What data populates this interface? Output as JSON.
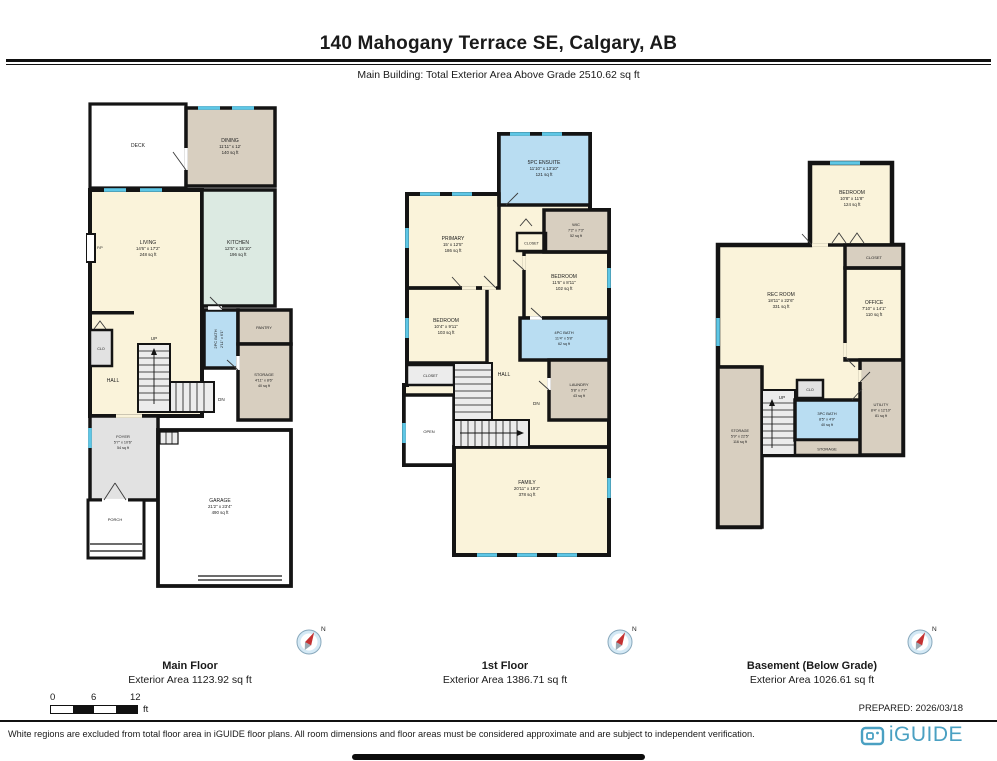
{
  "header": {
    "title": "140 Mahogany Terrace SE, Calgary, AB",
    "subtitle": "Main Building: Total Exterior Area Above Grade 2510.62 sq ft"
  },
  "plans": [
    {
      "name": "Main Floor",
      "area": "Exterior Area 1123.92 sq ft",
      "rooms": {
        "deck": {
          "name": "DECK"
        },
        "dining": {
          "name": "DINING",
          "dims": "11'11\" x 12'",
          "area": "140 sq ft"
        },
        "living": {
          "name": "LIVING",
          "dims": "14'6\" x 17'2\"",
          "area": "248 sq ft"
        },
        "kitchen": {
          "name": "KITCHEN",
          "dims": "12'5\" x 15'10\"",
          "area": "196 sq ft"
        },
        "bath": {
          "name": "2PC BATH",
          "dims": "2'11\" x 6'1\""
        },
        "pantry": {
          "name": "PANTRY"
        },
        "clo": {
          "name": "CLO"
        },
        "hall": {
          "name": "HALL"
        },
        "storage": {
          "name": "STORAGE",
          "dims": "4'11\" x 8'6\"",
          "area": "40 sq ft"
        },
        "foyer": {
          "name": "FOYER",
          "dims": "5'7\" x 10'6\"",
          "area": "54 sq ft"
        },
        "porch": {
          "name": "PORCH"
        },
        "garage": {
          "name": "GARAGE",
          "dims": "21'2\" x 23'4\"",
          "area": "490 sq ft"
        },
        "fp": {
          "name": "F/P"
        },
        "up": "UP",
        "dn": "DN"
      }
    },
    {
      "name": "1st Floor",
      "area": "Exterior Area 1386.71 sq ft",
      "rooms": {
        "ensuite": {
          "name": "5PC ENSUITE",
          "dims": "11'10\" x 13'10\"",
          "area": "121 sq ft"
        },
        "primary": {
          "name": "PRIMARY",
          "dims": "15' x 12'5\"",
          "area": "186 sq ft"
        },
        "wic": {
          "name": "WIC",
          "dims": "7'2\" x 7'3\"",
          "area": "52 sq ft"
        },
        "closet_top": {
          "name": "CLOSET"
        },
        "bedroom_right": {
          "name": "BEDROOM",
          "dims": "11'6\" x 8'11\"",
          "area": "102 sq ft"
        },
        "bedroom_left": {
          "name": "BEDROOM",
          "dims": "10'4\" x 9'11\"",
          "area": "103 sq ft"
        },
        "bath": {
          "name": "4PC BATH",
          "dims": "11'4\" x 5'8\"",
          "area": "62 sq ft"
        },
        "closet_left": {
          "name": "CLOSET"
        },
        "hall": {
          "name": "HALL"
        },
        "laundry": {
          "name": "LAUNDRY",
          "dims": "5'8\" x 7'7\"",
          "area": "43 sq ft"
        },
        "open": {
          "name": "OPEN"
        },
        "family": {
          "name": "FAMILY",
          "dims": "20'11\" x 19'2\"",
          "area": "378 sq ft"
        },
        "dn": "DN"
      }
    },
    {
      "name": "Basement (Below Grade)",
      "area": "Exterior Area 1026.61 sq ft",
      "rooms": {
        "bedroom": {
          "name": "BEDROOM",
          "dims": "10'8\" x 11'8\"",
          "area": "124 sq ft"
        },
        "closet": {
          "name": "CLOSET"
        },
        "rec": {
          "name": "REC ROOM",
          "dims": "18'11\" x 22'6\"",
          "area": "331 sq ft"
        },
        "office": {
          "name": "OFFICE",
          "dims": "7'10\" x 14'1\"",
          "area": "110 sq ft"
        },
        "clo": {
          "name": "CLO"
        },
        "bath": {
          "name": "3PC BATH",
          "dims": "8'5\" x 4'9\"",
          "area": "40 sq ft"
        },
        "utility": {
          "name": "UTILITY",
          "dims": "8'4\" x 12'10\"",
          "area": "81 sq ft"
        },
        "storage_center": {
          "name": "STORAGE"
        },
        "storage_left": {
          "name": "STORAGE",
          "dims": "5'9\" x 22'5\"",
          "area": "116 sq ft"
        },
        "up": "UP"
      }
    }
  ],
  "compass": {
    "north": "N"
  },
  "scale_bar": {
    "t0": "0",
    "t1": "6",
    "t2": "12",
    "unit": "ft"
  },
  "prepared": "PREPARED: 2026/03/18",
  "footer": {
    "disclaimer": "White regions are excluded from total floor area in iGUIDE floor plans. All room dimensions and floor areas must be considered approximate and are subject to independent verification.",
    "brand": "iGUIDE"
  },
  "colors": {
    "wall": "#141414",
    "window": "#5EC7E6",
    "cream": "#FAF3DA",
    "tan": "#D8CFC0",
    "blue": "#B9DDF2",
    "teal": "#DCEAE2",
    "gray": "#E2E2E2",
    "stairs": "#ECECEC",
    "white": "#FFFFFF",
    "brand": "#4AA0C2"
  }
}
